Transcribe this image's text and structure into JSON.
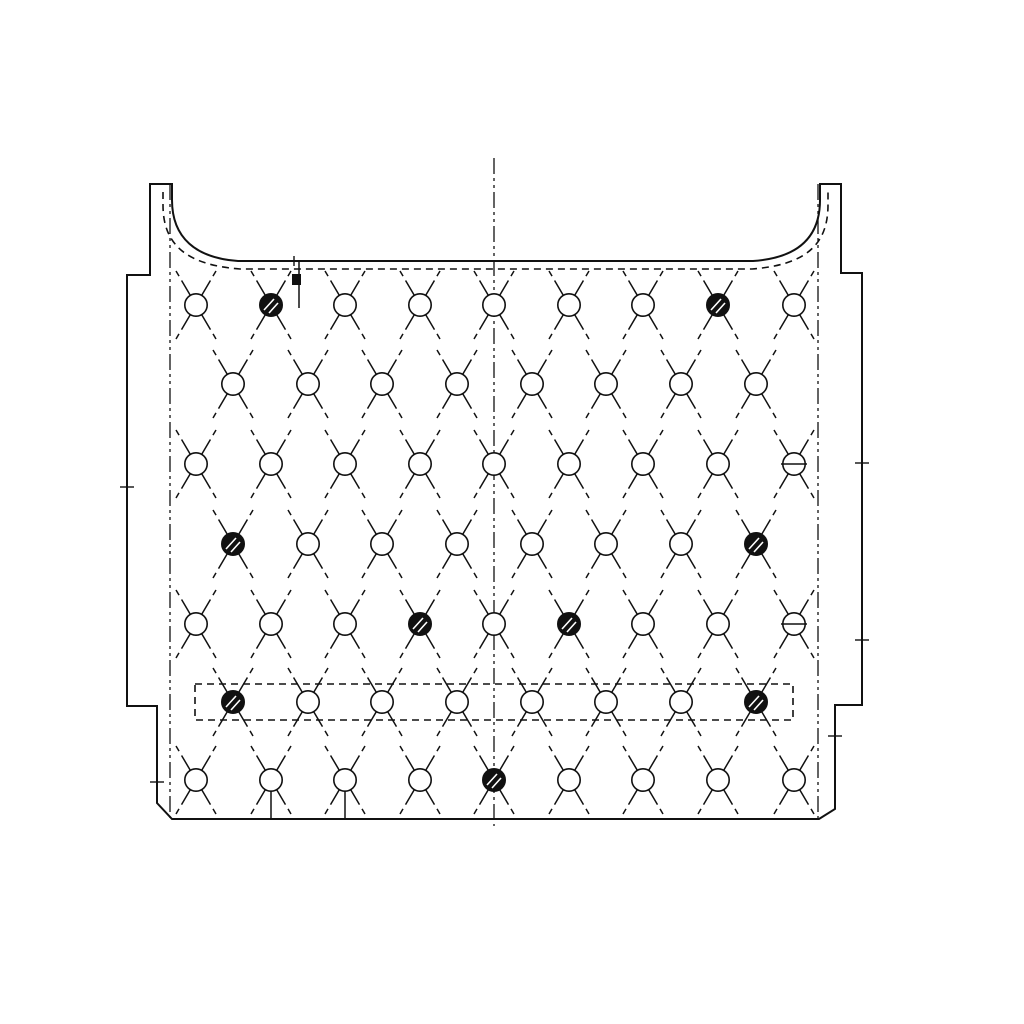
{
  "drawing": {
    "background_color": "#ffffff",
    "line_color": "#111111",
    "paths": {
      "outer_outline": "M150,184 H172 V200 C172,238 196,258 238,261 H753 C797,258 820,238 820,200 V184 H841 V273 H862 V705 H835 V809 L819,819 H172 L157,803 V706 H127 V275 H150 Z",
      "hidden_edge": "M163,192 V205 C163,246 188,265 240,269 H752 C804,265 828,246 828,205 V192"
    },
    "centerlines": [
      {
        "x": 170,
        "y1": 184,
        "y2": 818
      },
      {
        "x": 494,
        "y1": 158,
        "y2": 826
      },
      {
        "x": 818,
        "y1": 184,
        "y2": 818
      }
    ],
    "dashed_band": {
      "x": 195,
      "y": 684,
      "width": 598,
      "height": 36
    },
    "hole_rows": [
      {
        "y": 305,
        "xs": [
          196,
          271,
          345,
          420,
          494,
          569,
          643,
          718,
          794
        ],
        "types": [
          "o",
          "f",
          "o",
          "o",
          "o",
          "o",
          "o",
          "f",
          "o"
        ]
      },
      {
        "y": 384,
        "xs": [
          233,
          308,
          382,
          457,
          532,
          606,
          681,
          756
        ],
        "types": [
          "o",
          "o",
          "o",
          "o",
          "o",
          "o",
          "o",
          "o"
        ]
      },
      {
        "y": 464,
        "xs": [
          196,
          271,
          345,
          420,
          494,
          569,
          643,
          718,
          794
        ],
        "types": [
          "o",
          "o",
          "o",
          "o",
          "o",
          "o",
          "o",
          "o",
          "s"
        ]
      },
      {
        "y": 544,
        "xs": [
          233,
          308,
          382,
          457,
          532,
          606,
          681,
          756
        ],
        "types": [
          "f",
          "o",
          "o",
          "o",
          "o",
          "o",
          "o",
          "f"
        ]
      },
      {
        "y": 624,
        "xs": [
          196,
          271,
          345,
          420,
          494,
          569,
          643,
          718,
          794
        ],
        "types": [
          "o",
          "o",
          "o",
          "f",
          "o",
          "f",
          "o",
          "o",
          "s"
        ]
      },
      {
        "y": 702,
        "xs": [
          233,
          308,
          382,
          457,
          532,
          606,
          681,
          756
        ],
        "types": [
          "f",
          "o",
          "o",
          "o",
          "o",
          "o",
          "o",
          "f"
        ]
      },
      {
        "y": 780,
        "xs": [
          196,
          271,
          345,
          420,
          494,
          569,
          643,
          718,
          794
        ],
        "types": [
          "o",
          "o",
          "o",
          "o",
          "f",
          "o",
          "o",
          "o",
          "o"
        ]
      }
    ],
    "leader_lines": [
      {
        "x": 271,
        "y1": 791,
        "y2": 818
      },
      {
        "x": 345,
        "y1": 791,
        "y2": 818
      }
    ],
    "flag_marker": {
      "x": 299,
      "y1": 262,
      "y2": 308,
      "flag_w": 9,
      "flag_h": 11
    },
    "edge_ticks": [
      {
        "x": 127,
        "y": 487,
        "dir": "h"
      },
      {
        "x": 157,
        "y": 782,
        "dir": "h"
      },
      {
        "x": 862,
        "y": 463,
        "dir": "h"
      },
      {
        "x": 862,
        "y": 640,
        "dir": "h"
      },
      {
        "x": 835,
        "y": 736,
        "dir": "h"
      },
      {
        "x": 294,
        "y": 261,
        "dir": "v"
      }
    ],
    "symbol_geometry": {
      "circle_radius": 11.2,
      "leg_dx": 20,
      "leg_dy": 34,
      "slot_half_width": 13
    }
  }
}
